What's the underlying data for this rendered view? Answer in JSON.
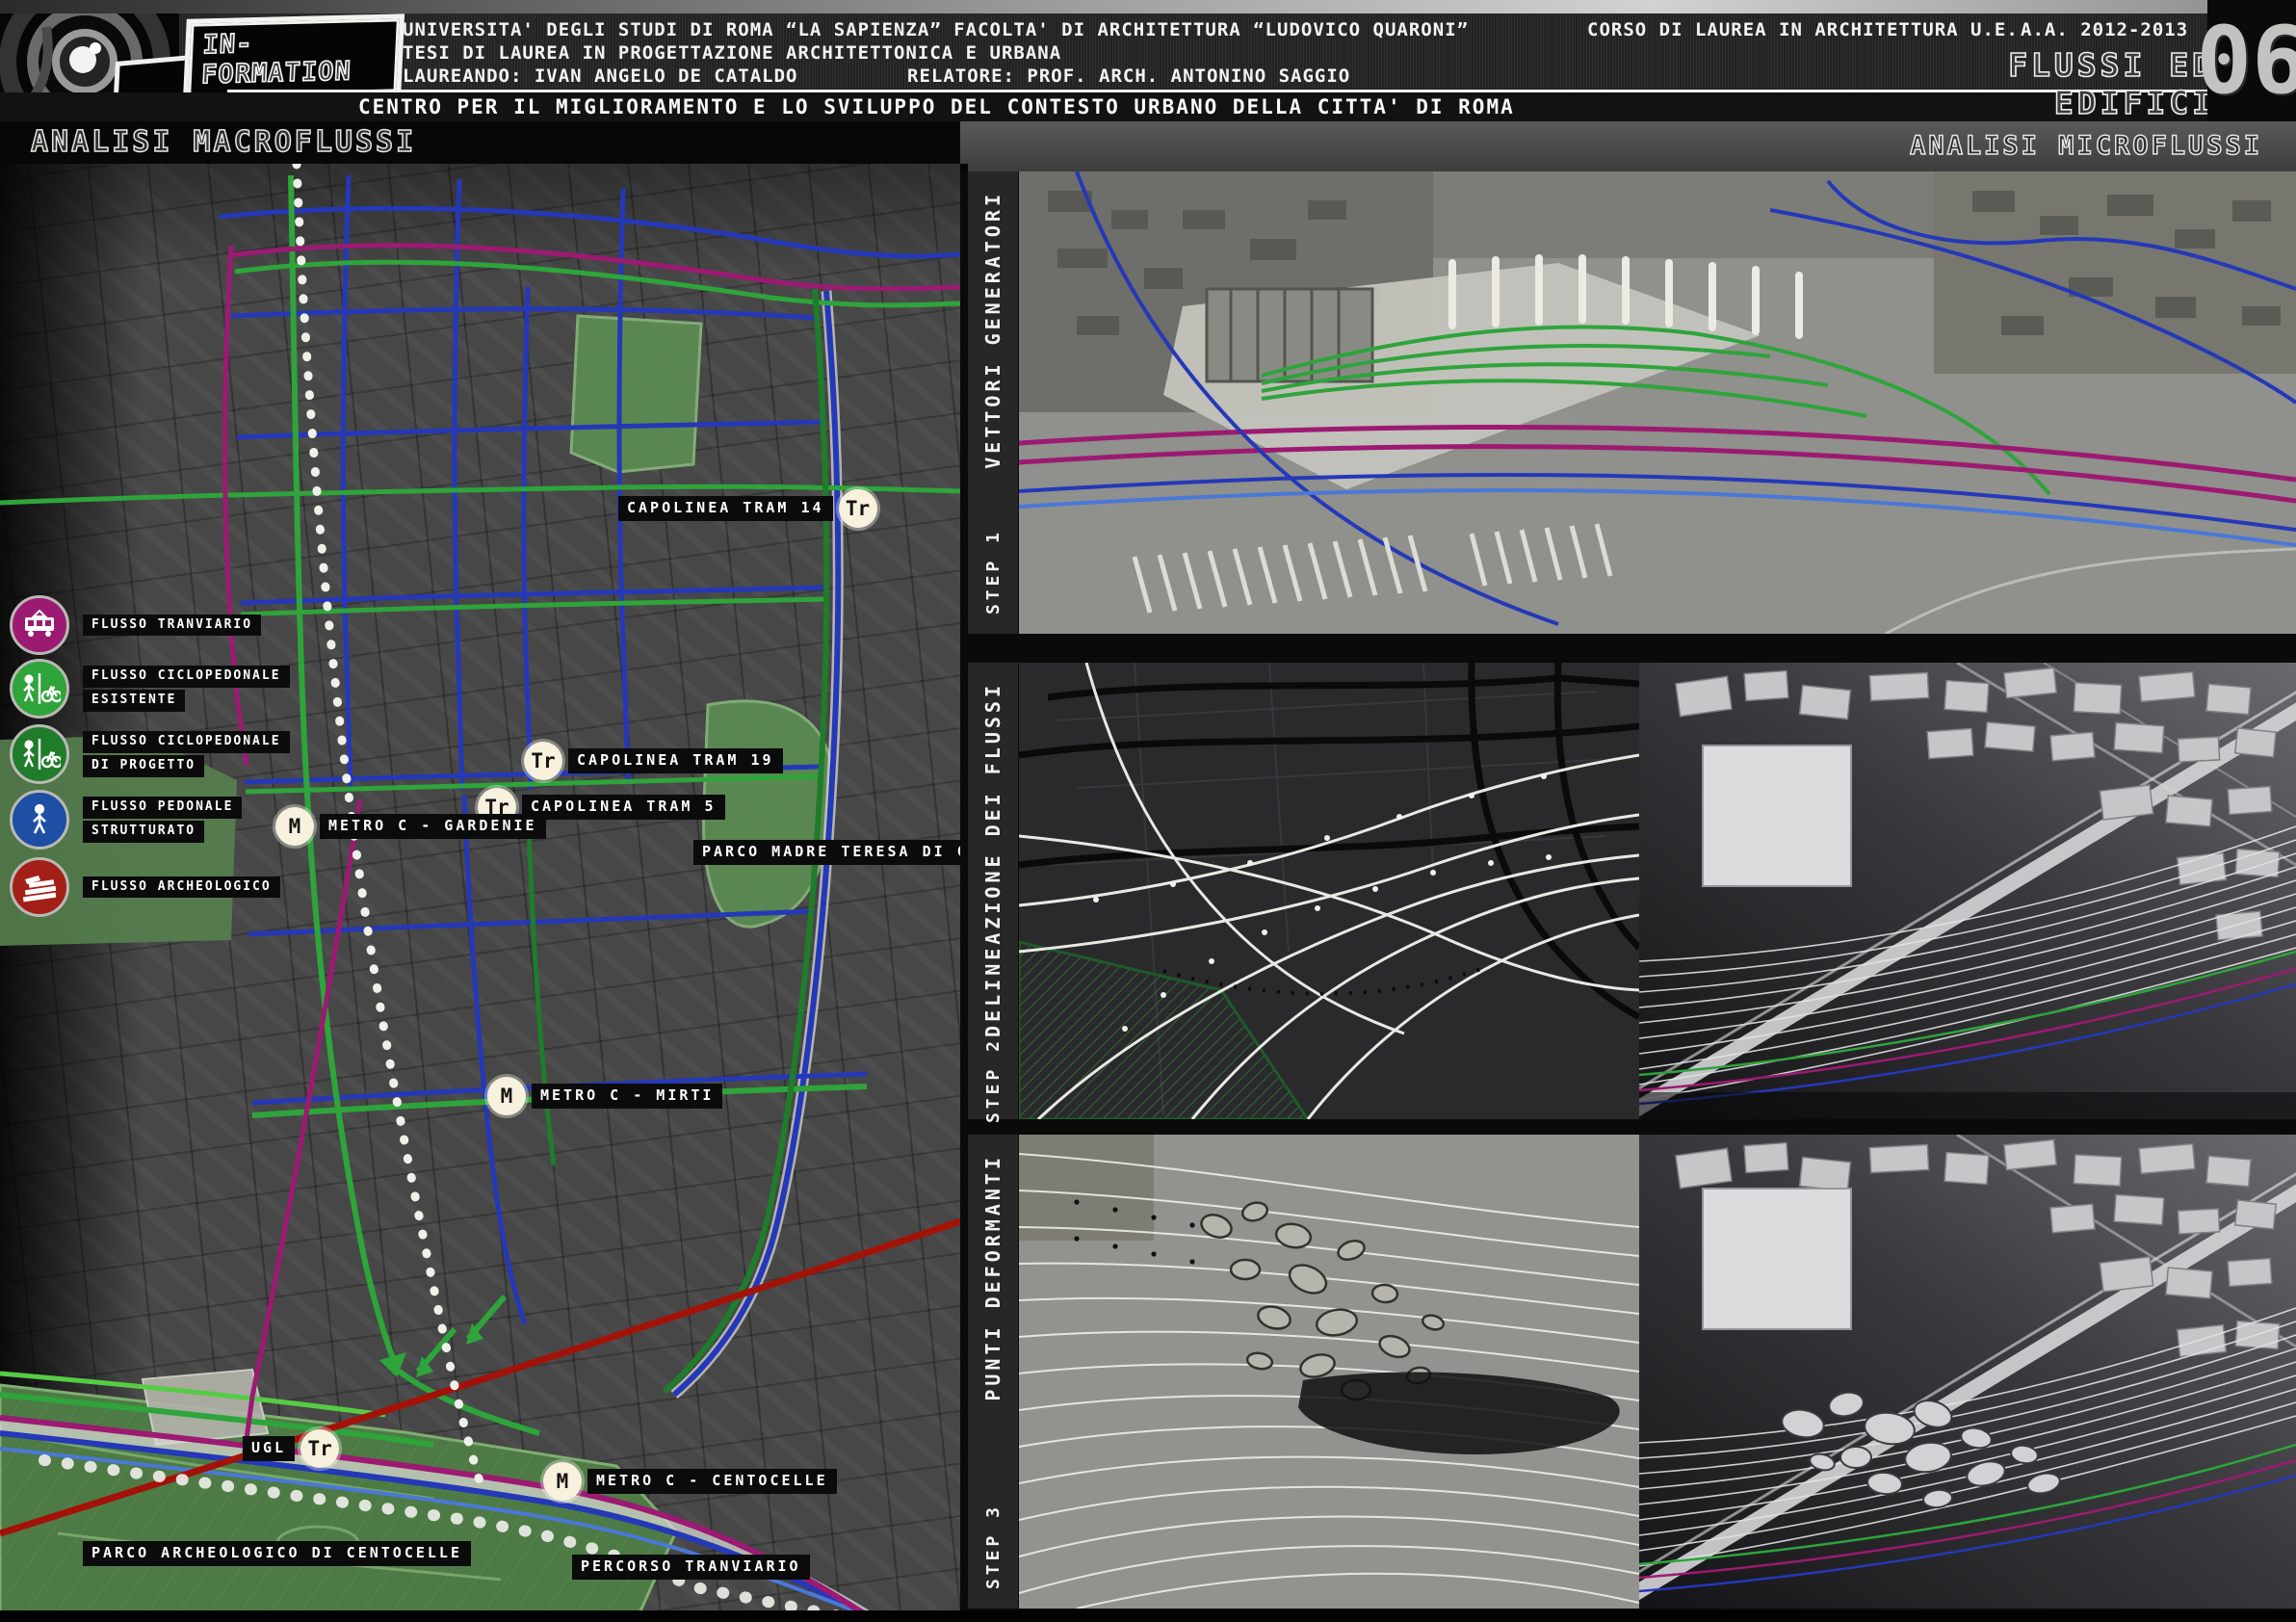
{
  "header": {
    "logo_text": "IN-FORMATION",
    "university_line": "UNIVERSITA' DEGLI STUDI DI ROMA “LA SAPIENZA” FACOLTA' DI ARCHITETTURA “LUDOVICO QUARONI”",
    "course_line": "CORSO DI LAUREA IN ARCHITETTURA U.E.",
    "academic_year": "A.A.  2012-2013",
    "thesis_line": "TESI DI LAUREA IN PROGETTAZIONE ARCHITETTONICA E URBANA",
    "candidate_line": "LAUREANDO: IVAN ANGELO DE CATALDO",
    "advisor_line": "RELATORE: PROF. ARCH.  ANTONINO SAGGIO",
    "subtitle": "CENTRO PER IL MIGLIORAMENTO E LO SVILUPPO DEL CONTESTO URBANO DELLA CITTA' DI ROMA",
    "sheet_title": "FLUSSI ED EDIFICI",
    "sheet_number": "06"
  },
  "sections": {
    "left_title": "ANALISI MACROFLUSSI",
    "right_title": "ANALISI MICROFLUSSI"
  },
  "badges": {
    "tram": "Tr",
    "metro": "M"
  },
  "legend": {
    "items": [
      {
        "line1": "FLUSSO TRANVIARIO",
        "line2": "",
        "color": "#9c1a72",
        "icon": "tram-icon"
      },
      {
        "line1": "FLUSSO CICLOPEDONALE",
        "line2": "ESISTENTE",
        "color": "#2ea43b",
        "icon": "pedestrian-bicycle-icon"
      },
      {
        "line1": "FLUSSO CICLOPEDONALE",
        "line2": "DI PROGETTO",
        "color": "#1f7c2a",
        "icon": "pedestrian-bicycle-icon"
      },
      {
        "line1": "FLUSSO PEDONALE",
        "line2": "STRUTTURATO",
        "color": "#1d4fa4",
        "icon": "pedestrian-icon"
      },
      {
        "line1": "FLUSSO ARCHEOLOGICO",
        "line2": "",
        "color": "#a32018",
        "icon": "archaeology-icon"
      }
    ]
  },
  "map": {
    "labels": {
      "capolinea_tram_14": "CAPOLINEA TRAM 14",
      "capolinea_tram_19": "CAPOLINEA TRAM 19",
      "capolinea_tram_5": "CAPOLINEA TRAM 5",
      "metro_gardenie": "METRO C - GARDENIE",
      "parco_madre_teresa": "PARCO MADRE TERESA DI CALCUTTA",
      "metro_mirti": "METRO C - MIRTI",
      "ugl": "UGL",
      "metro_centocelle": "METRO C - CENTOCELLE",
      "parco_archeologico": "PARCO ARCHEOLOGICO DI CENTOCELLE",
      "percorso_tranviario": "PERCORSO TRANVIARIO"
    }
  },
  "right_rows": [
    {
      "title": "VETTORI GENERATORI",
      "step": "STEP 1"
    },
    {
      "title": "DELINEAZIONE DEI FLUSSI",
      "step": "STEP 2"
    },
    {
      "title": "PUNTI DEFORMANTI",
      "step": "STEP 3"
    }
  ],
  "colors": {
    "flow_tram": "#9c1a72",
    "flow_cyclo_existing": "#2ea43b",
    "flow_cyclo_project": "#1f7c2a",
    "flow_pedestrian": "#2438b8",
    "flow_archaeological": "#a31208",
    "metro_dotted_line": "#f0f0ea",
    "badge_background": "#f7f1dd"
  }
}
